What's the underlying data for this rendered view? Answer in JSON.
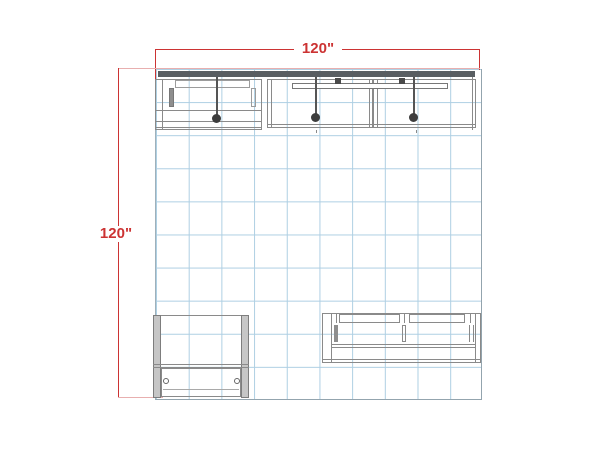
{
  "drawing": {
    "title": "exhibit-booth-floor-plan",
    "dimensions": {
      "width": {
        "label": "120\""
      },
      "height": {
        "label": "120\""
      }
    },
    "grid": {
      "columns": 10,
      "rows": 10
    },
    "fixtures": {
      "overhead_lights": 3,
      "backwall_sections": 3,
      "counters": 2
    },
    "colors": {
      "dimension_red": "#cc3333",
      "dimension_light_red": "#e8afaf",
      "grid_blue": "#aecfe3",
      "outline_gray": "#8a8a8a",
      "wall_dark": "#595e62",
      "light_fixture": "#3d3d3d",
      "panel_gray": "#c6c6c6",
      "background": "#ffffff"
    }
  }
}
